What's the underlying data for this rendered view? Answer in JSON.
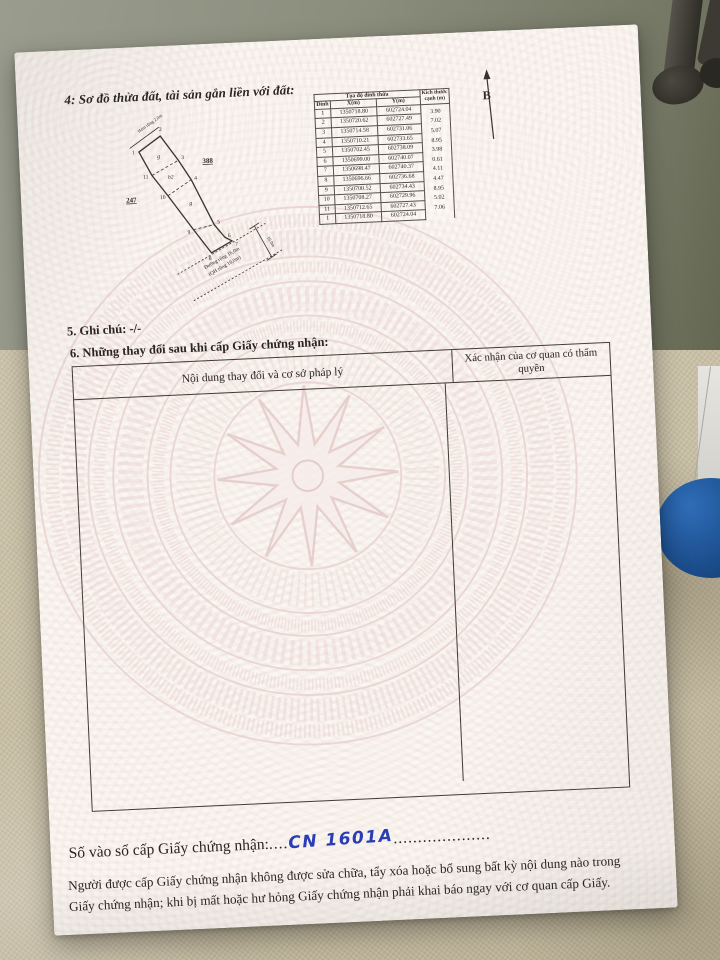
{
  "document": {
    "section4_title": "4: Sơ đồ thửa đất, tài sản gắn liền với đất:",
    "north_label": "B",
    "diagram": {
      "adjacent_parcel_left": "247",
      "adjacent_parcel_right": "388",
      "alley_label": "Hẻm rộng 2,0m",
      "road_label_line1": "Đường rộng 16,0m",
      "road_label_line2": "(QH rộng 16,0m)",
      "road_width_dim": "16.0m",
      "section_top": "g",
      "section_mid": "b2",
      "section_low": "g",
      "vertex_labels": [
        "1",
        "2",
        "3",
        "4",
        "5",
        "6",
        "7",
        "8",
        "9",
        "10",
        "11"
      ]
    },
    "coord_table": {
      "title": "Tọa độ đỉnh thửa",
      "col_vertex": "Đỉnh",
      "col_x": "X(m)",
      "col_y": "Y(m)",
      "col_size": "Kích thước cạnh (m)",
      "rows": [
        {
          "v": "1",
          "x": "1350718.80",
          "y": "602724.04",
          "d": "3.90"
        },
        {
          "v": "2",
          "x": "1350720.62",
          "y": "602727.49",
          "d": "7.02"
        },
        {
          "v": "3",
          "x": "1350714.58",
          "y": "602731.06",
          "d": "5.07"
        },
        {
          "v": "4",
          "x": "1350710.21",
          "y": "602733.65",
          "d": "8.95"
        },
        {
          "v": "5",
          "x": "1350702.45",
          "y": "602738.09",
          "d": "3.98"
        },
        {
          "v": "6",
          "x": "1350699.00",
          "y": "602740.07",
          "d": "0.61"
        },
        {
          "v": "7",
          "x": "1350698.47",
          "y": "602740.37",
          "d": "4.11"
        },
        {
          "v": "8",
          "x": "1350696.66",
          "y": "602736.68",
          "d": "4.47"
        },
        {
          "v": "9",
          "x": "1350700.52",
          "y": "602734.43",
          "d": "8.95"
        },
        {
          "v": "10",
          "x": "1350708.27",
          "y": "602729.96",
          "d": "5.02"
        },
        {
          "v": "11",
          "x": "1350712.65",
          "y": "602727.43",
          "d": "7.06"
        },
        {
          "v": "1",
          "x": "1350718.80",
          "y": "602724.04",
          "d": ""
        }
      ]
    },
    "section5": "5. Ghi chú: -/-",
    "section6_title": "6. Những thay đổi sau khi cấp Giấy chứng nhận:",
    "changes_table": {
      "col1": "Nội dung thay đổi và cơ sở pháp lý",
      "col2": "Xác nhận của cơ quan có thẩm quyền"
    },
    "registry_line": {
      "label": "Số vào sổ cấp Giấy chứng nhận:",
      "dots_before": "....",
      "handwritten": "CN 1601A",
      "dots_after": "...................."
    },
    "footer_line1": "Người được cấp Giấy chứng nhận không được sửa chữa, tẩy xóa hoặc bổ sung bất kỳ nội dung nào trong",
    "footer_line2": "Giấy chứng nhận; khi bị mất hoặc hư hỏng Giấy chứng nhận phải khai báo ngay với cơ quan cấp Giấy."
  },
  "colors": {
    "handwriting_blue": "#2a3db5",
    "guilloche_pink": "#e9d2cf",
    "ink": "#2a2520",
    "floor_olive": "#8b8d7d",
    "fabric_beige": "#c6bca2",
    "stool_blue": "#1c4f8e"
  }
}
